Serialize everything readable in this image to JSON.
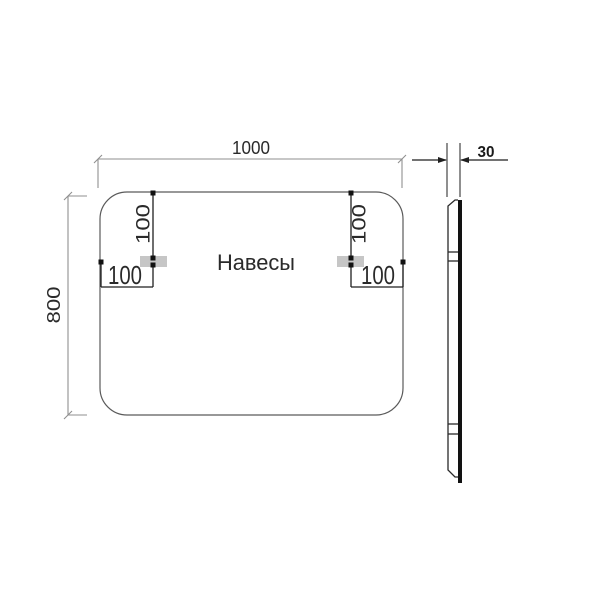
{
  "drawing": {
    "front": {
      "width_label": "1000",
      "height_label": "800",
      "hangers_label": "Навесы",
      "left_bracket": {
        "top_offset_label": "100",
        "side_offset_label": "100"
      },
      "right_bracket": {
        "top_offset_label": "100",
        "side_offset_label": "100"
      }
    },
    "side": {
      "thickness_label": "30"
    },
    "colors": {
      "dim_line_gray": "#8f8f8f",
      "annotation_black": "#1f1f1f",
      "panel_outline": "#5a5a5a",
      "bracket_fill": "#c6c6c6",
      "glass_black": "#121212",
      "text_color": "#2a2a2a"
    }
  }
}
